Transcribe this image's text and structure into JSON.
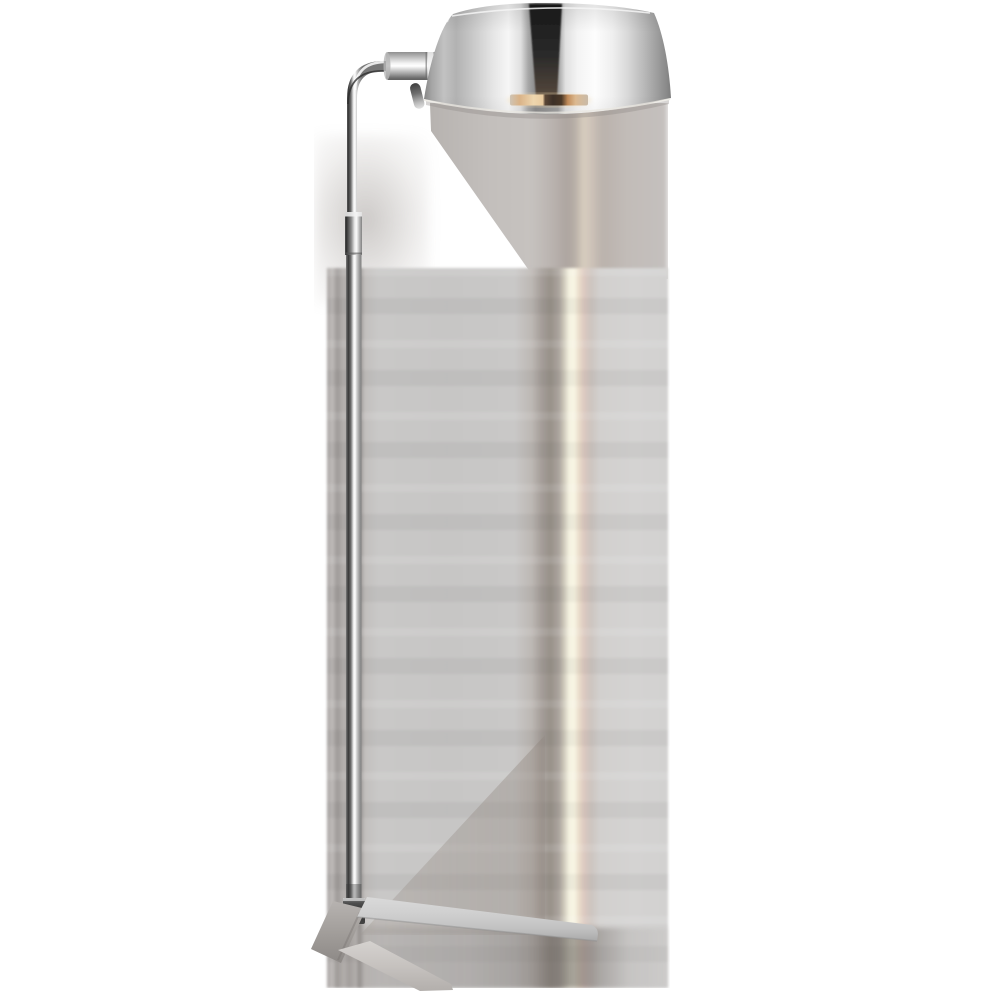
{
  "image": {
    "type": "product-photograph",
    "subject": "Pharmacy-style floor lamp in polished nickel",
    "details": "Dome metal shade at top facing down-right, horizontal arm with small adjustment knob, 90-degree elbow into a thin vertical rod, telescoping collar joint, long lower stem tube, dark hub at bottom joining an angular wedge base with two splayed legs; soft blurred gray reflection column with a warm cream light streak runs vertically behind the stem; white background",
    "visible_text": ""
  },
  "colors": {
    "page-bg": "#ffffff",
    "nickel-bright": "#ffffff",
    "nickel-light": "#e8e8e8",
    "nickel-mid": "#b5b5b5",
    "nickel-dark": "#6f6f6f",
    "shade-stripe-dark": "#242424",
    "bulb-warm": "#e6c796",
    "bulb-socket": "#3f332a",
    "backdrop-gray": "#c9c8c7",
    "backdrop-taupe": "#a09a95",
    "streak-cream": "#f5f2e1",
    "streak-pink": "#dbc8c0",
    "base-gray": "#cecece",
    "shadow-gray": "#8e8a88"
  }
}
